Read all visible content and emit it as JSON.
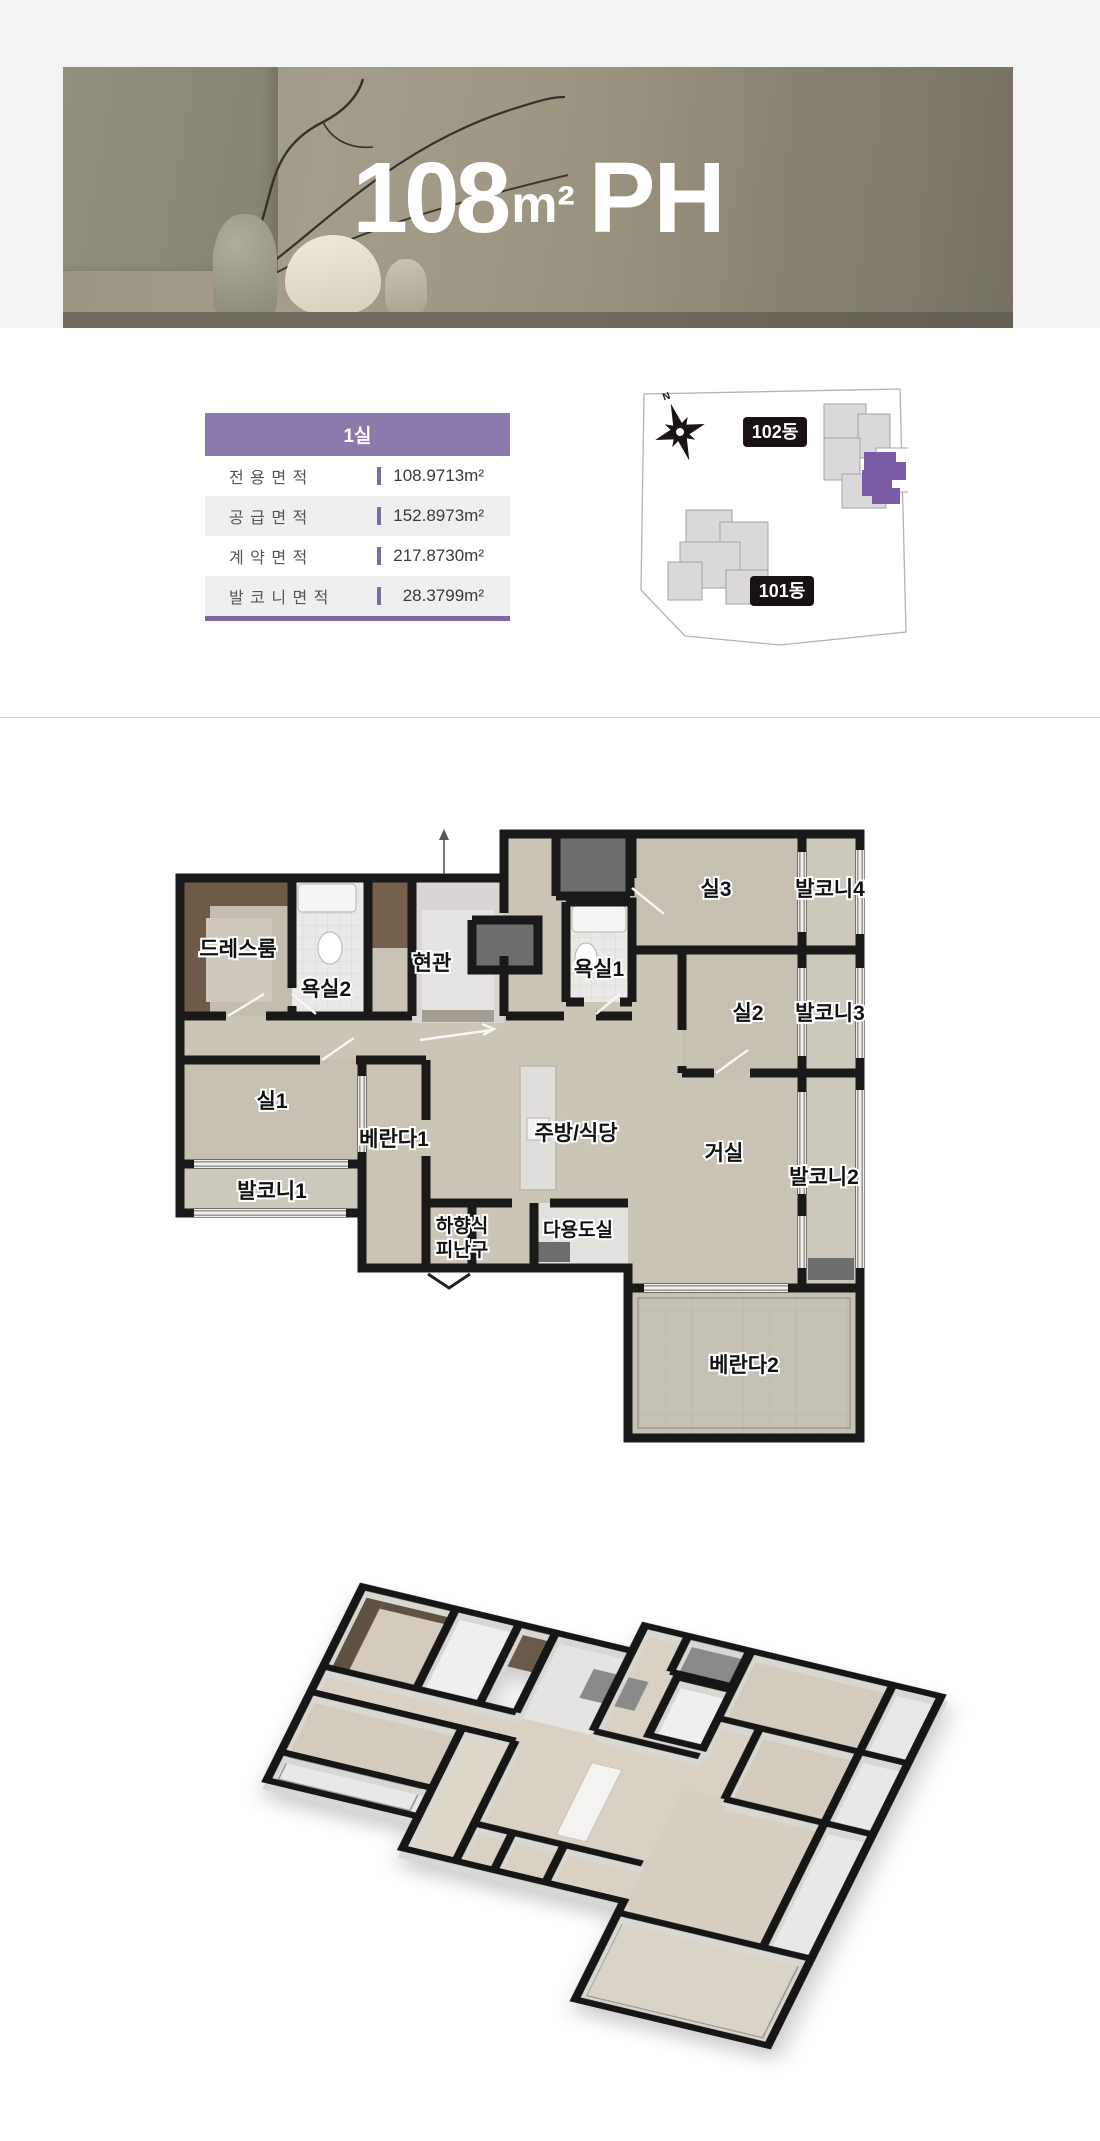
{
  "banner": {
    "title_number": "108",
    "title_unit": "m²",
    "title_suffix": "PH"
  },
  "unit_info": {
    "header": "1실",
    "rows": [
      {
        "label": "전 용 면 적",
        "value": "108.9713m²"
      },
      {
        "label": "공 급 면 적",
        "value": "152.8973m²"
      },
      {
        "label": "계 약 면 적",
        "value": "217.8730m²"
      },
      {
        "label": "발 코 니 면 적",
        "value": "28.3799m²"
      }
    ]
  },
  "site_map": {
    "compass_label": "N",
    "building_102": "102동",
    "building_101": "101동",
    "highlight_color": "#7a5ca6"
  },
  "floor_plan": {
    "labels": {
      "dressroom": "드레스룸",
      "bath2": "욕실2",
      "entrance": "현관",
      "bath1": "욕실1",
      "room3": "실3",
      "balcony4": "발코니4",
      "room2": "실2",
      "balcony3": "발코니3",
      "room1": "실1",
      "veranda1": "베란다1",
      "kitchen": "주방/식당",
      "living": "거실",
      "balcony2": "발코니2",
      "balcony1": "발코니1",
      "escape_line1": "하향식",
      "escape_line2": "피난구",
      "utility": "다용도실",
      "veranda2": "베란다2"
    }
  },
  "colors": {
    "accent_purple": "#8d7aac",
    "accent_purple_dark": "#7e6ba5",
    "unit_highlight": "#7a5ca6"
  }
}
